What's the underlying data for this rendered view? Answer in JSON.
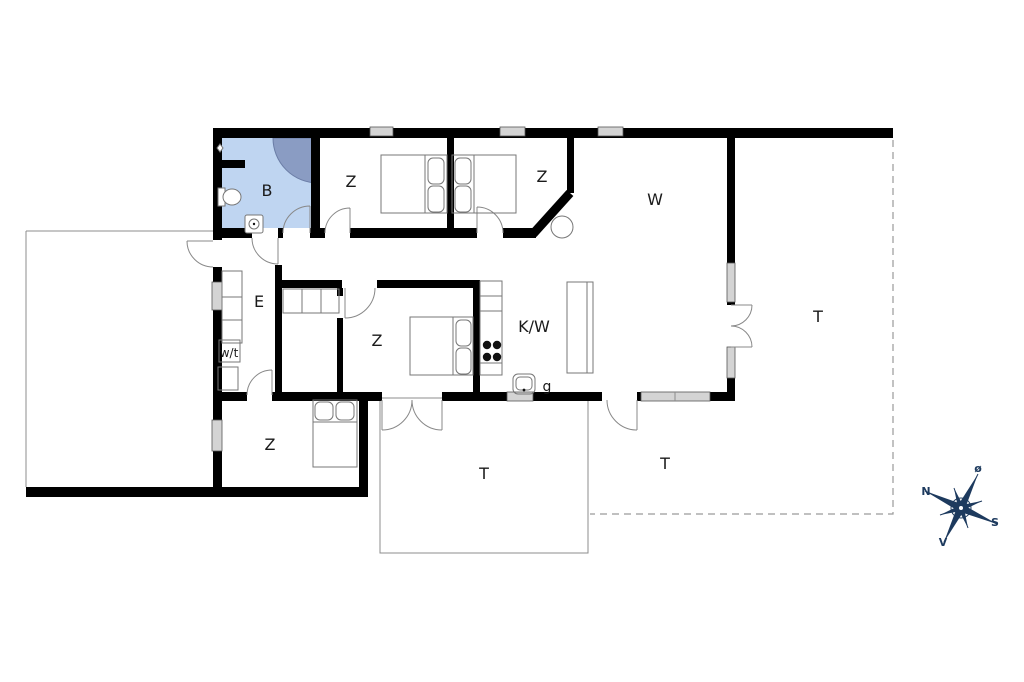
{
  "labels": {
    "bathroom": "B",
    "bedroom_top_left": "Z",
    "bedroom_top_right": "Z",
    "living_room": "W",
    "entrance": "E",
    "bedroom_middle": "Z",
    "bedroom_lower": "Z",
    "kitchen": "K/W",
    "utility": "w/t",
    "grill": "g",
    "terrace_east": "T",
    "terrace_southeast": "T",
    "terrace_south": "T"
  },
  "compass": {
    "north": "N",
    "south": "S",
    "east": "ø",
    "west": "V"
  },
  "colors": {
    "wall": "#000000",
    "bath": "#bfd5f1",
    "shower": "#8a9cc3",
    "window": "#d4d4d4",
    "outline": "#8c8c8c",
    "dashed": "#9a9a9a",
    "label": "#1a1a1a",
    "compass": "#1d3a5e"
  }
}
